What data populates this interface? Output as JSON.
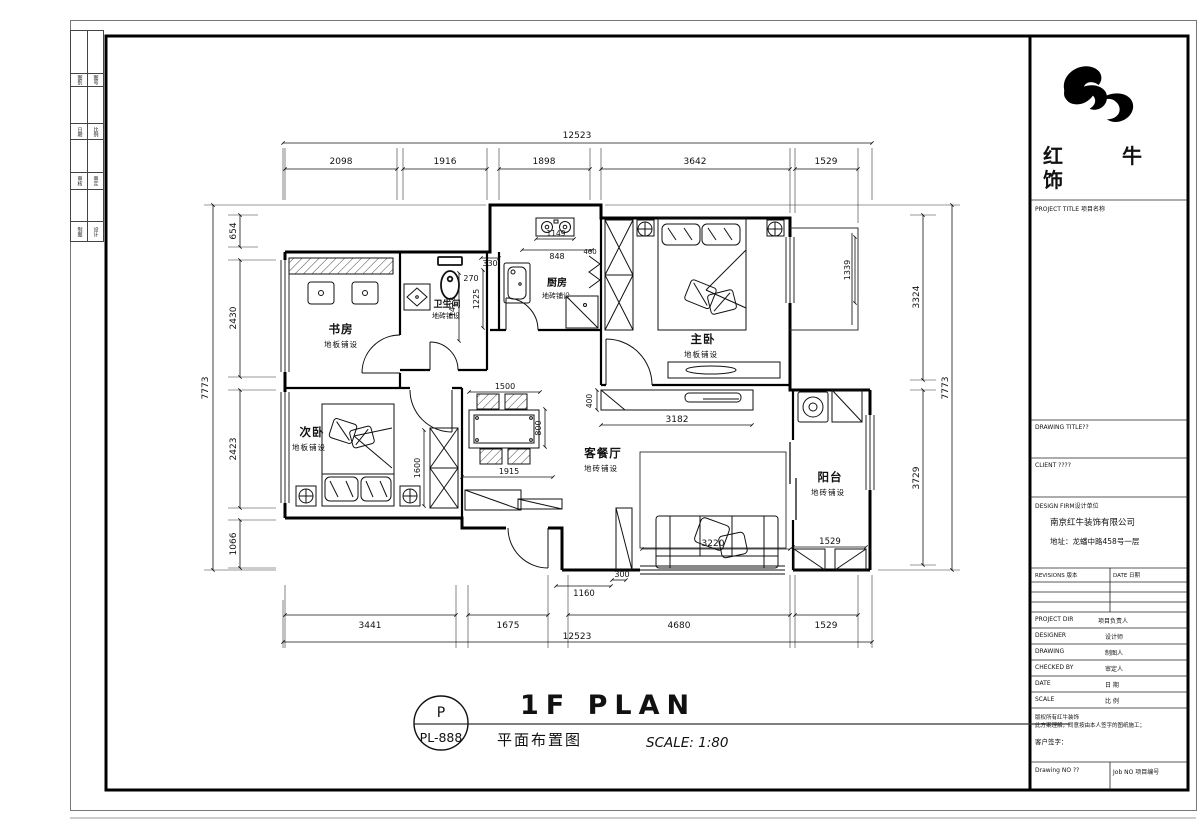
{
  "edge_table": {
    "rows": [
      [
        "图别",
        "图号"
      ],
      [
        "日期",
        "比例"
      ],
      [
        "审核",
        "审定"
      ],
      [
        "制图",
        "设计"
      ]
    ]
  },
  "logo": {
    "line1": "红 牛 装",
    "line2": "饰"
  },
  "titleblock": {
    "project_title": "PROJECT TITLE 项目名称",
    "drawing_title": "DRAWING TITLE??",
    "client": "CLIENT ????",
    "design_firm": "DESIGN FIRM设计单位",
    "firm_name": "南京红牛装饰有限公司",
    "firm_address": "地址：龙蟠中路458号一层",
    "revisions": "REVISIONS 版本",
    "date_col": "DATE 日期",
    "rows": [
      {
        "en": "PROJECT DIR",
        "cn": "项目负责人"
      },
      {
        "en": "DESIGNER",
        "cn": "设计师"
      },
      {
        "en": "DRAWING",
        "cn": "制图人"
      },
      {
        "en": "CHECKED BY",
        "cn": "审定人"
      },
      {
        "en": "DATE",
        "cn": "日 期"
      },
      {
        "en": "SCALE",
        "cn": "比 例"
      }
    ],
    "note1": "版权所有红牛装饰",
    "note2": "此方案理解，同意按由本人签字的图纸施工；",
    "note3": "客户签字：",
    "drawing_no": "Drawing NO ??",
    "job_no": "Job NO 项目编号"
  },
  "titlebar": {
    "badge_letter": "P",
    "badge_code": "PL-888",
    "title_en": "1F PLAN",
    "title_cn": "平面布置图",
    "scale": "SCALE: 1:80"
  },
  "rooms": {
    "study": {
      "name": "书房",
      "finish": "地板铺设"
    },
    "bath": {
      "name": "卫生间",
      "finish": "地砖铺设"
    },
    "kitchen": {
      "name": "厨房",
      "finish": "地砖铺设"
    },
    "master": {
      "name": "主卧",
      "finish": "地板铺设"
    },
    "second": {
      "name": "次卧",
      "finish": "地板铺设"
    },
    "living": {
      "name": "客餐厅",
      "finish": "地砖铺设"
    },
    "balcony": {
      "name": "阳台",
      "finish": "地砖铺设"
    }
  },
  "dims": {
    "top_total": "12523",
    "top1": "2098",
    "top2": "1916",
    "top3": "1898",
    "top4": "3642",
    "top5": "1529",
    "left_total": "7773",
    "left1": "654",
    "left2": "2430",
    "left3": "2423",
    "left4": "1066",
    "right_total": "7773",
    "right1": "3324",
    "right2": "3729",
    "window": "1339",
    "bottom_total": "12523",
    "bottom1": "3441",
    "bottom2": "1675",
    "bottom3": "4680",
    "bottom4": "1529",
    "bath_330": "330",
    "bath_270": "270",
    "bath_1423": "1423",
    "bath_1225": "1225",
    "stove_1149": "1149",
    "kitchen_848": "848",
    "kitchen_460": "460",
    "dining_1500": "1500",
    "dining_800": "800",
    "hall_1915": "1915",
    "tv_400": "400",
    "living_3182": "3182",
    "sofa_3220": "3220",
    "entry_1160": "1160",
    "entry_300": "300",
    "wardrobe_1600": "1600",
    "balcony_1529": "1529"
  }
}
